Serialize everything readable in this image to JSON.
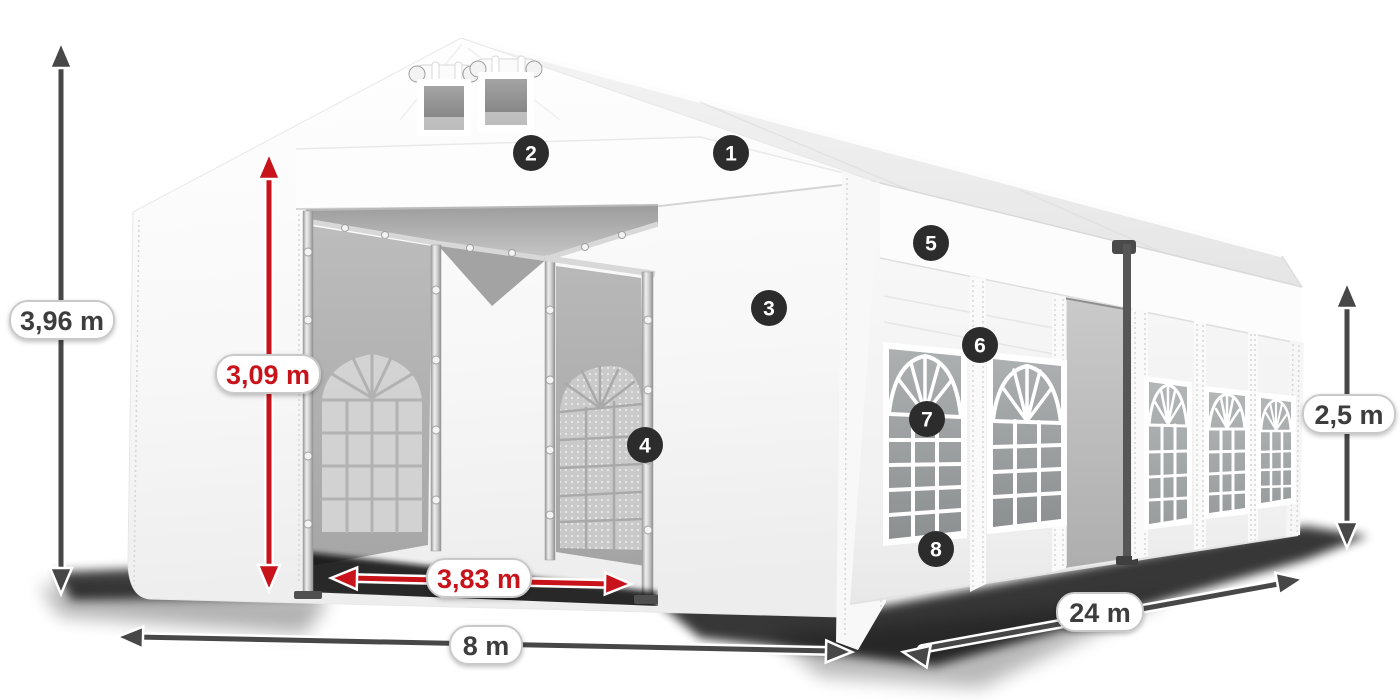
{
  "diagram": {
    "dimensions": {
      "total_height": "3,96 m",
      "entrance_height": "3,09 m",
      "entrance_width": "3,83 m",
      "front_width": "8 m",
      "side_length": "24 m",
      "side_wall_height": "2,5 m"
    },
    "callouts": [
      {
        "number": "1"
      },
      {
        "number": "2"
      },
      {
        "number": "3"
      },
      {
        "number": "4"
      },
      {
        "number": "5"
      },
      {
        "number": "6"
      },
      {
        "number": "7"
      },
      {
        "number": "8"
      }
    ],
    "colors": {
      "dimension_red": "#c8131b",
      "dimension_dark": "#474747",
      "badge_background": "#2c2c2c",
      "label_text": "#3d3d3d",
      "tent_white": "#ffffff"
    }
  }
}
